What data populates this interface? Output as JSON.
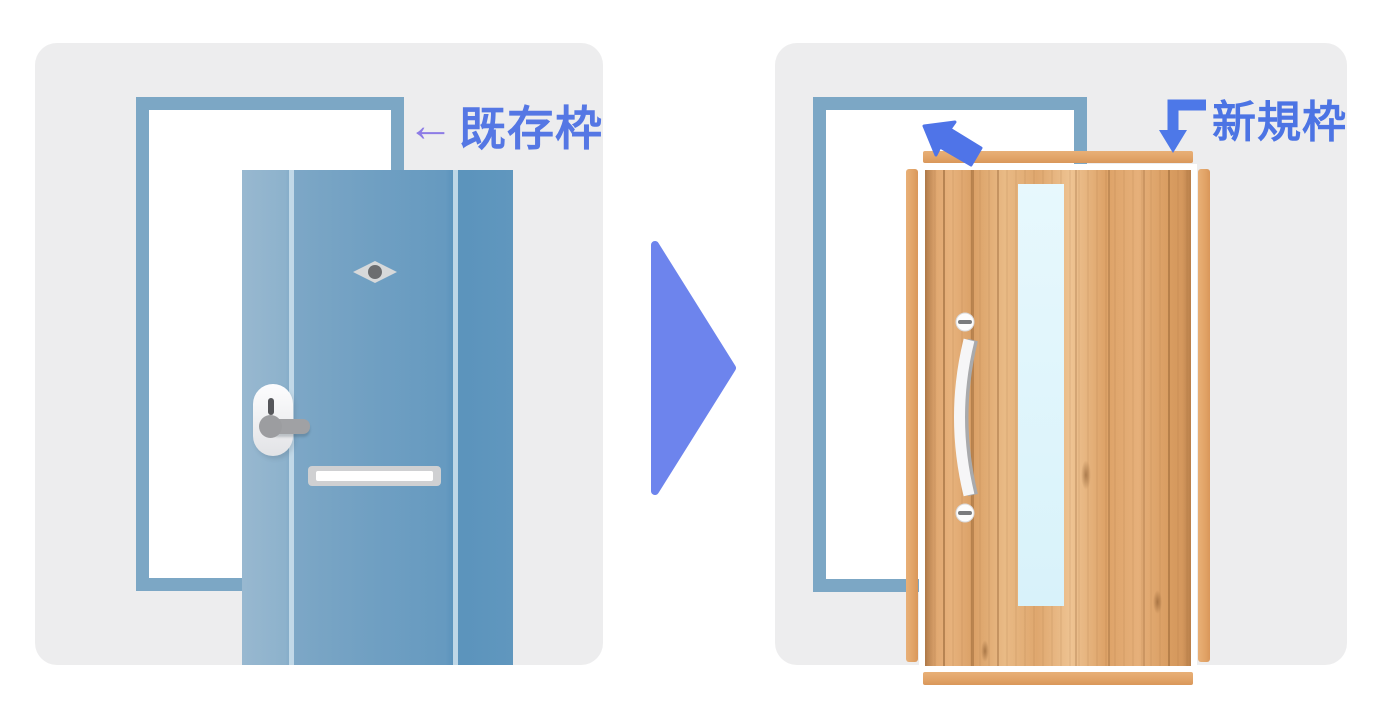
{
  "captions": {
    "existing_frame_arrow": "←",
    "existing_frame_text": "既存枠",
    "new_frame_text": "新規枠"
  },
  "icons": {
    "left_arrow": "left-arrow pointing at existing door frame",
    "corner_arrow": "corner arrow pointing down at new frame top bar",
    "transition_arrow": "large right-pointing triangle between before/after scenes",
    "install_arrow": "arrow pointing up-left showing new frame installed over existing frame"
  },
  "colors": {
    "canvas_background": "#ffffff",
    "panel_background": "#ededee",
    "existing_frame_blue": "#7ca7c5",
    "old_door_blue": "#6f9fc2",
    "new_frame_orange": "#e2a468",
    "wood_base": "#e0a96f",
    "glass_blue": "#ddf3fa",
    "caption_existing_blue": "#5577e4",
    "caption_existing_arrow_purple": "#8d7ce6",
    "caption_new_blue": "#4c74e4",
    "transition_arrow_blue": "#6d84ed",
    "install_arrow_blue": "#4f74e8",
    "hardware_gray": "#a0a1a4"
  }
}
